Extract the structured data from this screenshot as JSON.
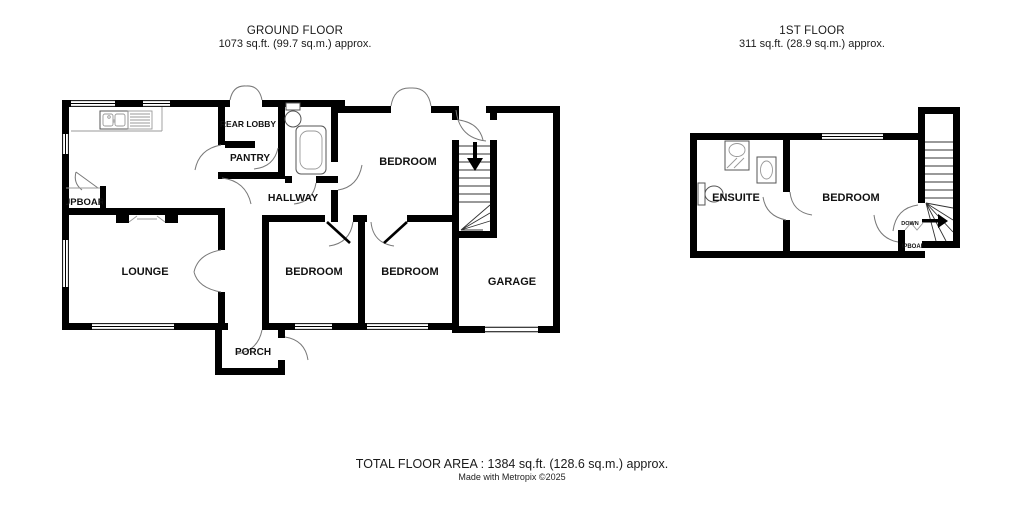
{
  "ground_floor": {
    "title": "GROUND FLOOR",
    "area": "1073 sq.ft. (99.7 sq.m.) approx.",
    "rooms": {
      "rear_lobby": "REAR LOBBY",
      "pantry": "PANTRY",
      "hallway": "HALLWAY",
      "cupboard": "CUPBOARD",
      "lounge": "LOUNGE",
      "bedroom_rear": "BEDROOM",
      "bedroom_front_left": "BEDROOM",
      "bedroom_front_middle": "BEDROOM",
      "garage": "GARAGE",
      "porch": "PORCH"
    }
  },
  "first_floor": {
    "title": "1ST FLOOR",
    "area": "311 sq.ft. (28.9 sq.m.) approx.",
    "rooms": {
      "ensuite": "ENSUITE",
      "bedroom": "BEDROOM",
      "cupboard": "CUPBOARD"
    },
    "stairs": {
      "down_label": "DOWN"
    }
  },
  "footer": {
    "total_area": "TOTAL FLOOR AREA : 1384 sq.ft. (128.6 sq.m.) approx.",
    "credit": "Made with Metropix ©2025"
  },
  "colors": {
    "wall": "#000000",
    "text": "#1a1a1a",
    "background": "#ffffff"
  }
}
